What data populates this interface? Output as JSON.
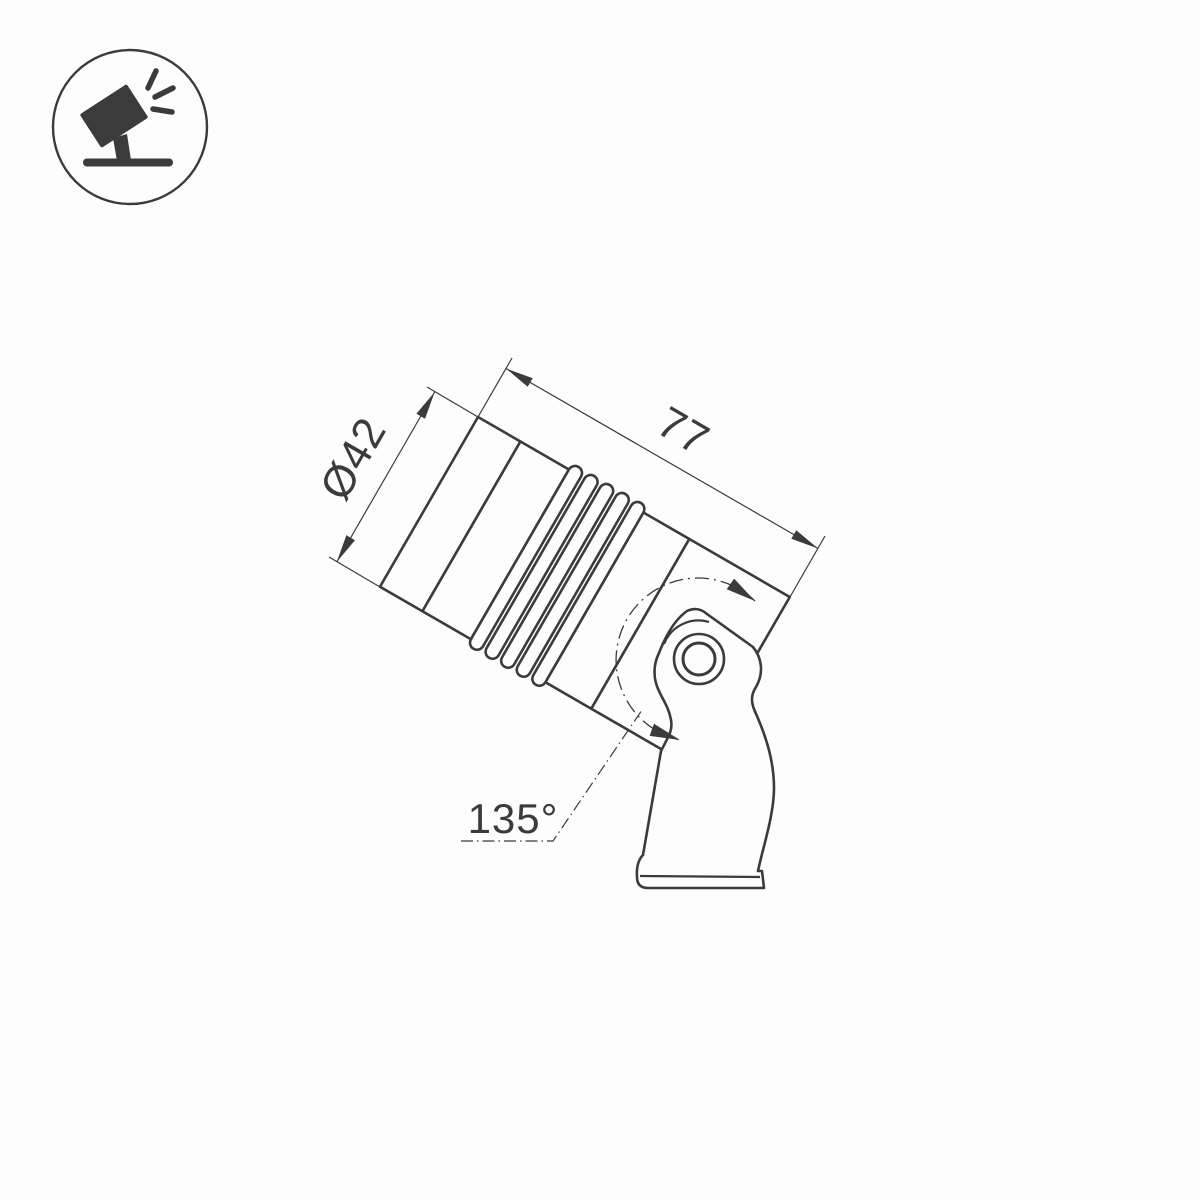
{
  "meta": {
    "background_color": "#fdfdfd",
    "line_color": "#3b3b3b",
    "drawing_type": "technical dimension drawing of tiltable spotlight fixture"
  },
  "icon": {
    "name": "tilted-spotlight-icon",
    "description": "circled pictogram of a tilted spotlight on a ground stand emitting rays"
  },
  "dimensions": {
    "diameter": {
      "label": "Ø42",
      "value_mm": 42
    },
    "length": {
      "label": "77",
      "value_mm": 77
    },
    "tilt_angle": {
      "label": "135°",
      "value_deg": 135
    }
  }
}
